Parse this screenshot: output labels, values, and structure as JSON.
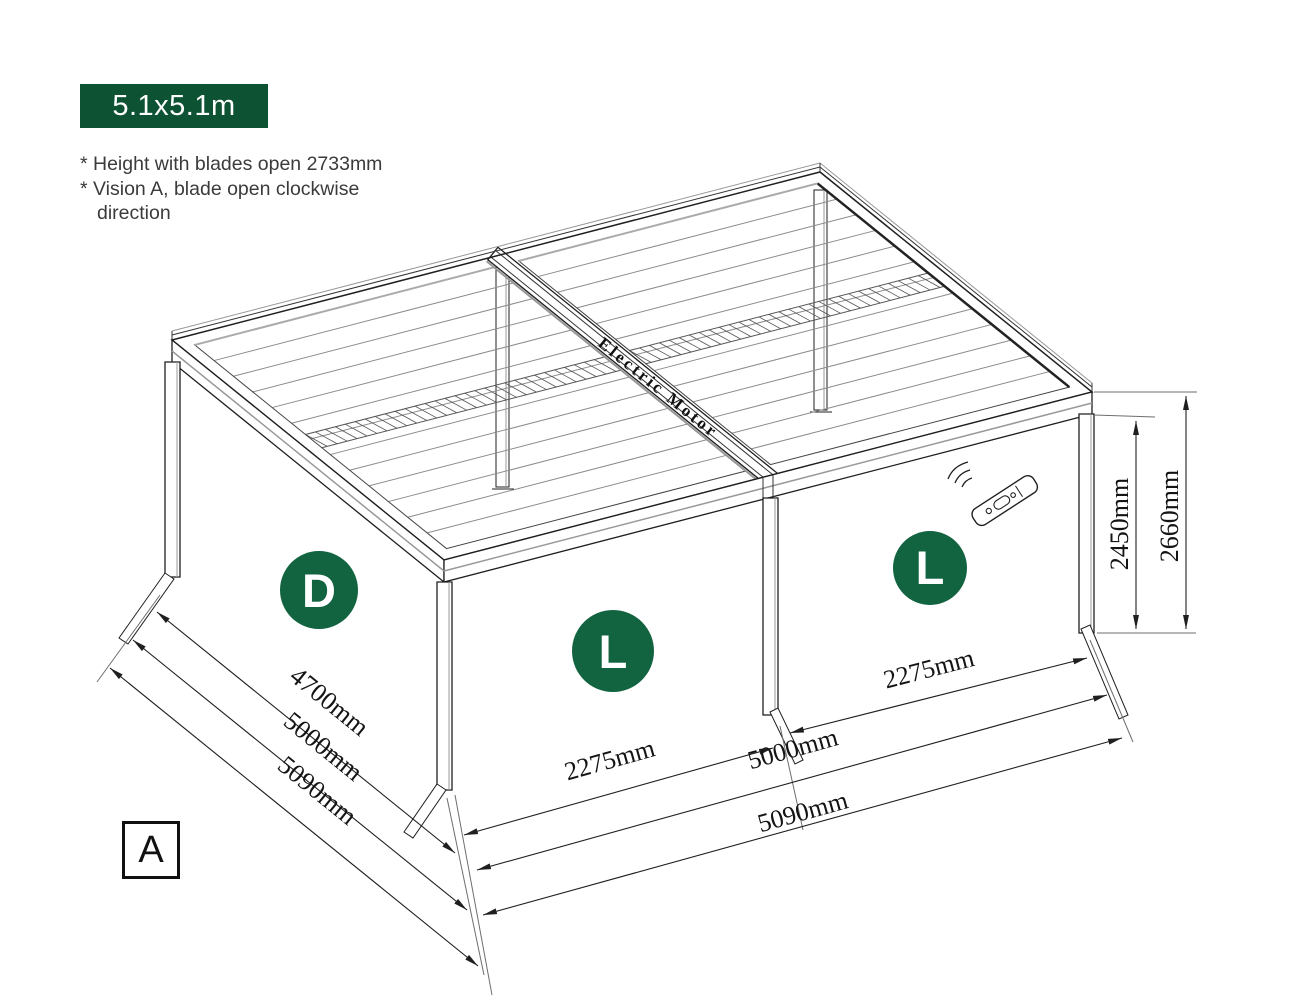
{
  "badge": {
    "label": "5.1x5.1m",
    "background": "#0d5233",
    "color": "#ffffff"
  },
  "notes": {
    "line1": "* Height with blades open 2733mm",
    "line2": "* Vision A, blade open clockwise",
    "line3": "direction"
  },
  "diagram": {
    "type": "isometric louvered-roof pergola technical drawing",
    "motor_label": "Electric Motor",
    "view_label": "A",
    "area_markers": {
      "left_side": "D",
      "front_left": "L",
      "front_right": "L"
    },
    "marker_color": "#126340",
    "icons": [
      "remote-control-icon"
    ],
    "dimensions": {
      "left_side": [
        "4700mm",
        "5000mm",
        "5090mm"
      ],
      "front_left_bay": "2275mm",
      "front_right_bay": "2275mm",
      "front_inner_width": "5000mm",
      "front_overall_width": "5090mm",
      "post_height": "2450mm",
      "overall_height": "2660mm"
    },
    "colors": {
      "ink": "#1f1f1f",
      "louver_gray": "#8c8c8c",
      "accent_gray": "#999999"
    }
  }
}
